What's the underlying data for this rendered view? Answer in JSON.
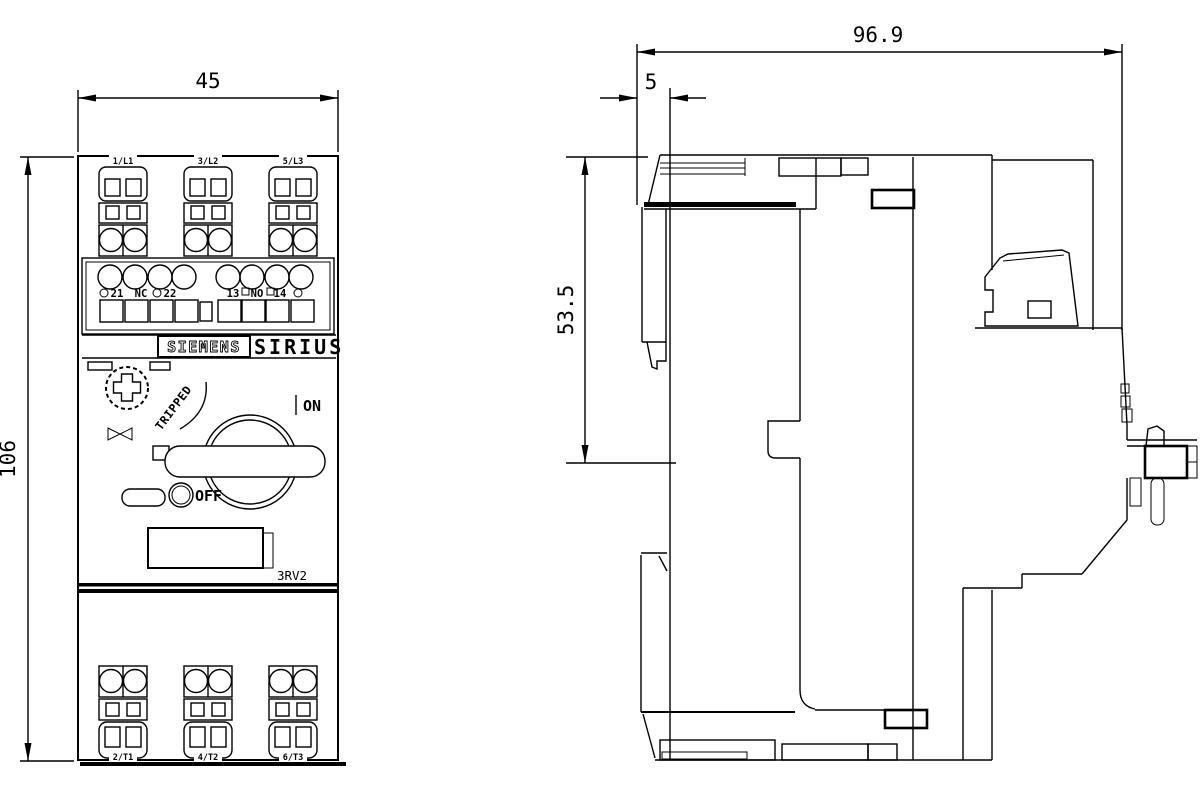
{
  "drawing_title": "SIRIUS 3RV2 motor starter protector dimension drawing",
  "colors": {
    "line": "#000000",
    "background": "#ffffff"
  },
  "front_view": {
    "dim_width": "45",
    "dim_height": "106",
    "top_terminals": [
      "1/L1",
      "3/L2",
      "5/L3"
    ],
    "aux_nc": [
      "21",
      "NC",
      "22"
    ],
    "aux_no": [
      "13",
      "NO",
      "14"
    ],
    "brand": "SIEMENS",
    "series": "SIRIUS",
    "state_tripped": "TRIPPED",
    "state_on": "ON",
    "state_off": "OFF",
    "model": "3RV2",
    "bottom_terminals": [
      "2/T1",
      "4/T2",
      "6/T3"
    ]
  },
  "side_view": {
    "dim_depth": "96.9",
    "dim_clip": "5",
    "dim_upper": "53.5"
  }
}
